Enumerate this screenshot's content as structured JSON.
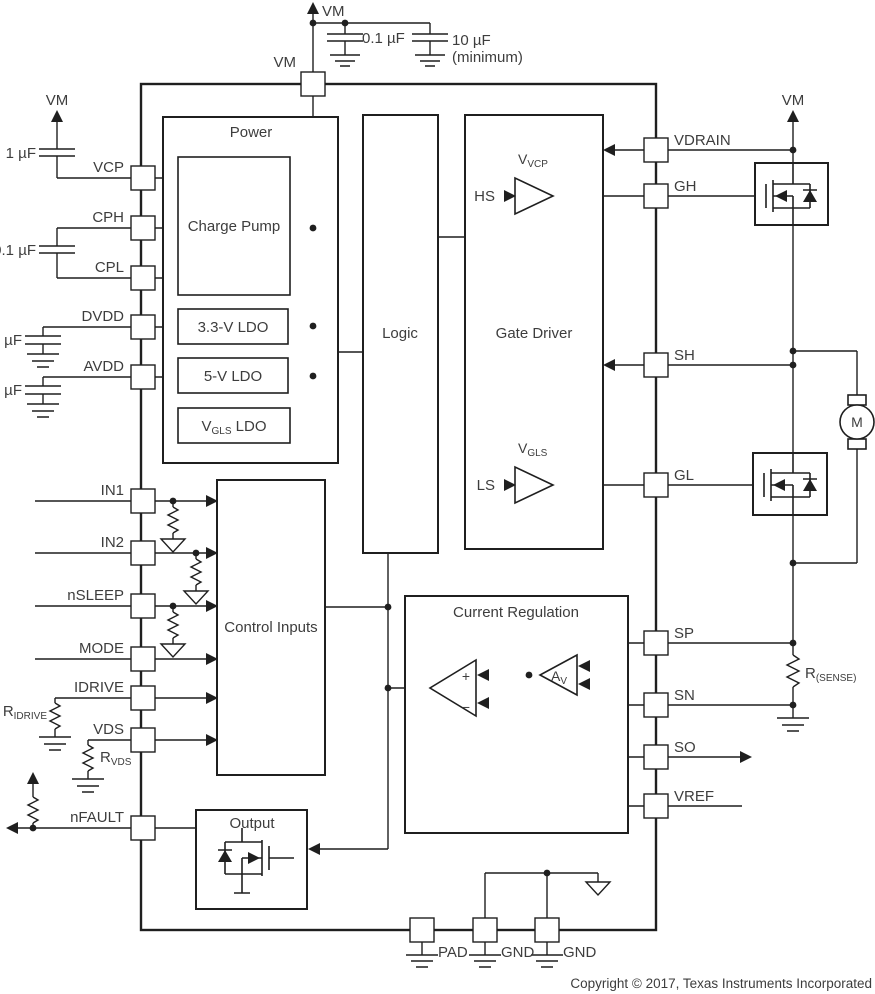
{
  "footer": {
    "copyright": "Copyright © 2017, Texas Instruments Incorporated"
  },
  "pins": {
    "top": {
      "vm": "VM"
    },
    "left": {
      "vcp": "VCP",
      "cph": "CPH",
      "cpl": "CPL",
      "dvdd": "DVDD",
      "avdd": "AVDD",
      "in1": "IN1",
      "in2": "IN2",
      "nsleep": "nSLEEP",
      "mode": "MODE",
      "idrive": "IDRIVE",
      "vds": "VDS",
      "nfault": "nFAULT"
    },
    "right": {
      "vdrain": "VDRAIN",
      "gh": "GH",
      "sh": "SH",
      "gl": "GL",
      "sp": "SP",
      "sn": "SN",
      "so": "SO",
      "vref": "VREF"
    },
    "bottom": {
      "pad": "PAD",
      "gnd1": "GND",
      "gnd2": "GND"
    }
  },
  "blocks": {
    "power": "Power",
    "charge_pump": "Charge Pump",
    "ldo_3v3": "3.3-V LDO",
    "ldo_5v": "5-V LDO",
    "ldo_vgls": {
      "main": "V",
      "sub": "GLS",
      "rest": " LDO"
    },
    "logic": "Logic",
    "gate_driver": "Gate Driver",
    "control_inputs": "Control Inputs",
    "current_regulation": "Current Regulation",
    "output": "Output"
  },
  "signals": {
    "hs": "HS",
    "ls": "LS",
    "v_vcp": {
      "main": "V",
      "sub": "VCP"
    },
    "v_gls": {
      "main": "V",
      "sub": "GLS"
    },
    "av": {
      "main": "A",
      "sub": "V"
    },
    "comparator_plus": "+",
    "comparator_minus": "−"
  },
  "supplies": {
    "vm_top": "VM",
    "vm_left": "VM",
    "vm_right": "VM"
  },
  "components": {
    "cap_bulk1": "0.1 µF",
    "cap_bulk2_line1": "10 µF",
    "cap_bulk2_line2": "(minimum)",
    "cap_vcp": "1 µF",
    "cap_flying": "0.1 µF",
    "cap_dvdd": "1 µF",
    "cap_avdd": "1 µF",
    "r_idrive": {
      "main": "R",
      "sub": "IDRIVE"
    },
    "r_vds": {
      "main": "R",
      "sub": "VDS"
    },
    "r_sense": {
      "main": "R",
      "sub": "(SENSE)"
    },
    "motor": "M"
  }
}
